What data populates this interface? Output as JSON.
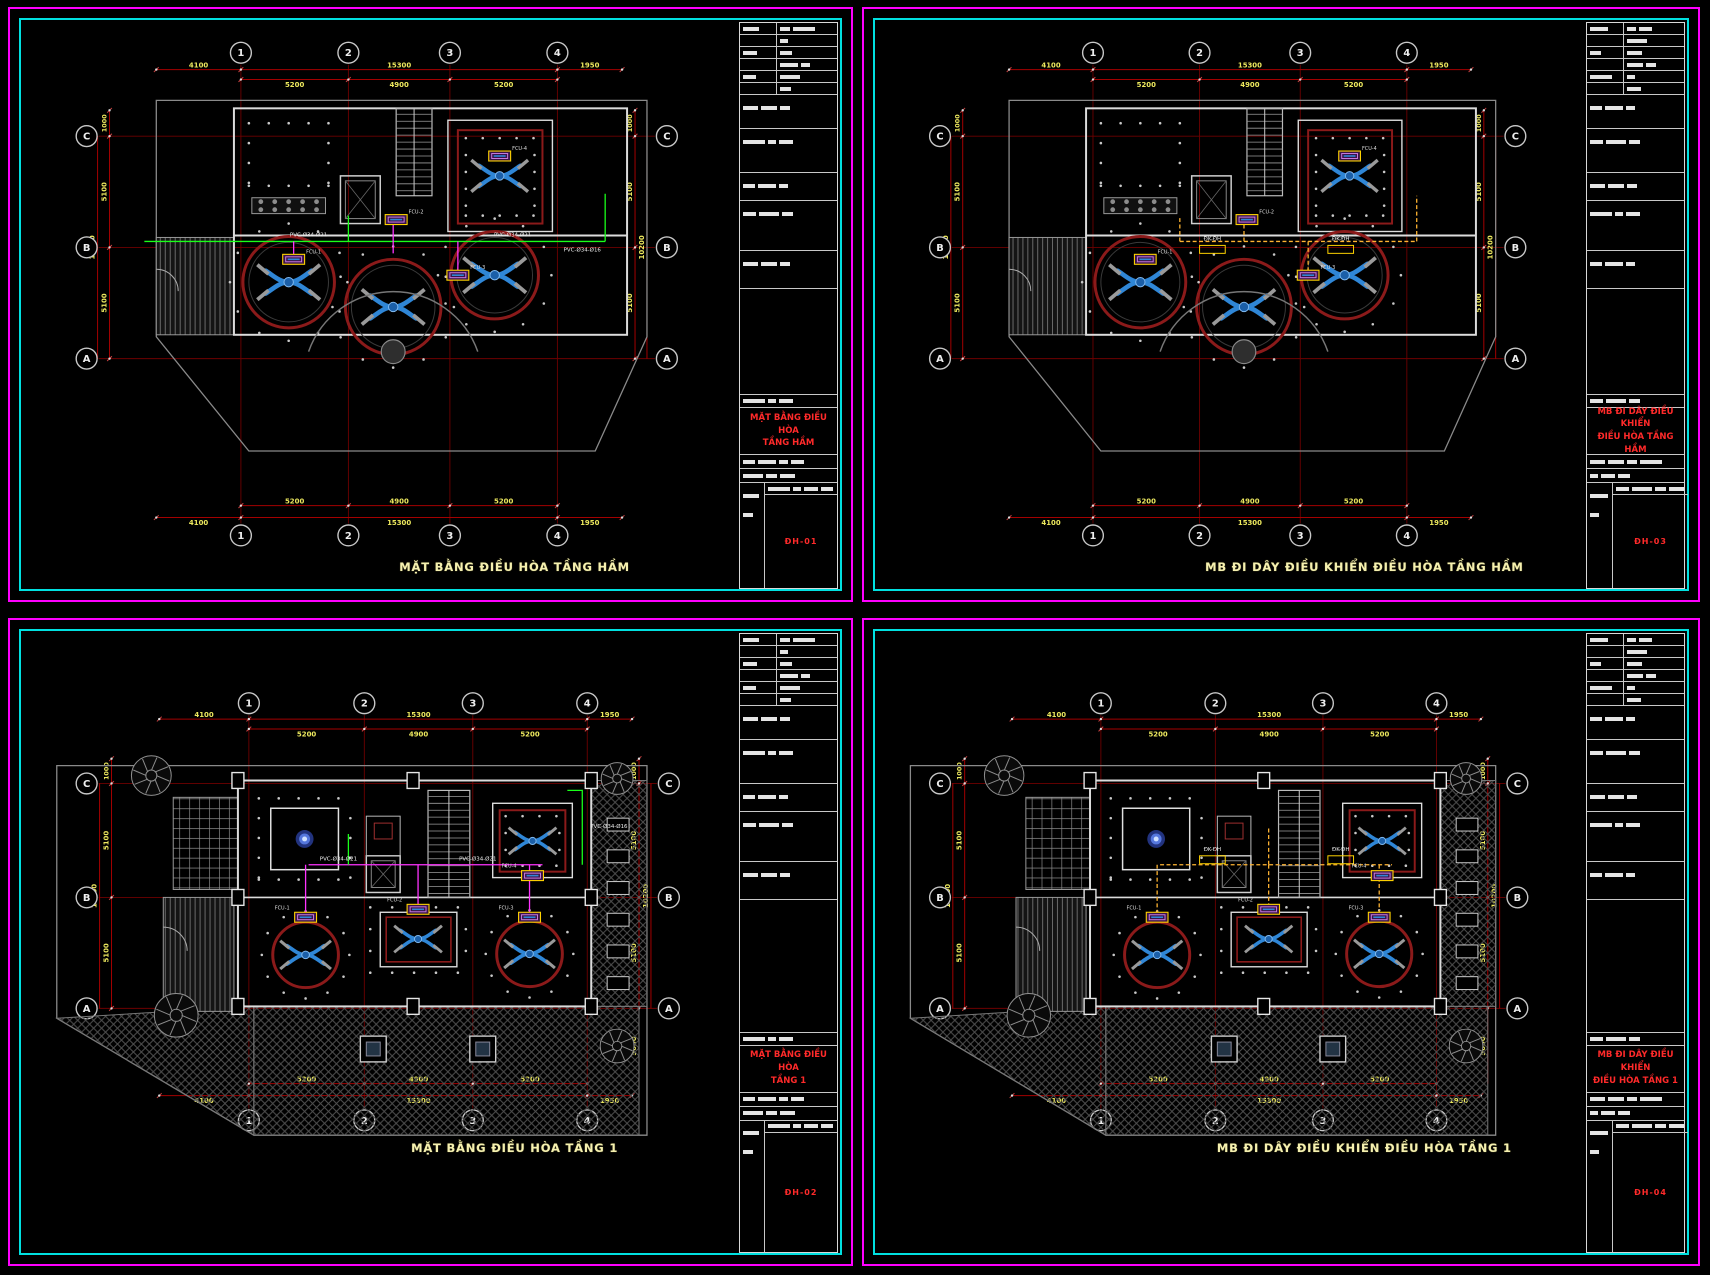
{
  "app": {
    "title": "HVAC layout drawing - 4 sheets"
  },
  "colors": {
    "sheet_border": "#FF00FF",
    "inner_border": "#00E0E0",
    "grid_line": "#6E0000",
    "dim_line": "#A40000",
    "dim_text": "#EDE95E",
    "caption_text": "#F5F0B0",
    "block_title_red": "#FF2A2A",
    "wall": "#DCDCDC",
    "property_line": "#8A8A8A",
    "room_circle": "#8B1A1A",
    "duct_blue": "#2F86D6",
    "pipe_green": "#19FF19",
    "wire_magenta": "#FF33FF",
    "control_orange": "#FFB432",
    "fcu_yellow": "#FFD400",
    "glow_blue": "#4A72FF"
  },
  "grid": {
    "cols": [
      "1",
      "2",
      "3",
      "4"
    ],
    "rows": [
      "C",
      "B",
      "A"
    ]
  },
  "dims": {
    "h_outer": [
      "4100",
      "15300",
      "1950"
    ],
    "h_inner": [
      "5200",
      "4900",
      "5200"
    ],
    "v_inner": [
      "5100",
      "5100"
    ],
    "v_outer": "10200",
    "v_top": "1000",
    "v_extra_floor1": "5650"
  },
  "sheets": [
    {
      "id": "tl",
      "kind": "basement",
      "wiring": "pipe",
      "caption": "MẶT BẰNG ĐIỀU HÒA TẦNG HẦM",
      "block_title": [
        "MẶT BẰNG ĐIỀU HÒA",
        "TẦNG HẦM"
      ],
      "sheet_no": "ĐH-01"
    },
    {
      "id": "tr",
      "kind": "basement",
      "wiring": "control",
      "caption": "MB ĐI DÂY ĐIỀU KHIỂN ĐIỀU HÒA TẦNG HẦM",
      "block_title": [
        "MB ĐI DÂY ĐIỀU KHIỂN",
        "ĐIỀU HÒA TẦNG HẦM"
      ],
      "sheet_no": "ĐH-03"
    },
    {
      "id": "bl",
      "kind": "floor1",
      "wiring": "pipe",
      "caption": "MẶT BẰNG ĐIỀU HÒA TẦNG 1",
      "block_title": [
        "MẶT BẰNG ĐIỀU HÒA",
        "TẦNG 1"
      ],
      "sheet_no": "ĐH-02"
    },
    {
      "id": "br",
      "kind": "floor1",
      "wiring": "control",
      "caption": "MB ĐI DÂY ĐIỀU KHIỂN ĐIỀU HÒA TẦNG 1",
      "block_title": [
        "MB ĐI DÂY ĐIỀU KHIỂN",
        "ĐIỀU HÒA TẦNG 1"
      ],
      "sheet_no": "ĐH-04"
    }
  ],
  "plan_labels": {
    "pipe": [
      "PVC-Ø34-Ø21",
      "PVC-Ø34-Ø21",
      "PVC-Ø34-Ø16"
    ],
    "control": [
      "ĐK-ĐH",
      "ĐK-ĐH"
    ],
    "fcu": [
      "FCU-1",
      "FCU-2",
      "FCU-3",
      "FCU-4"
    ]
  }
}
